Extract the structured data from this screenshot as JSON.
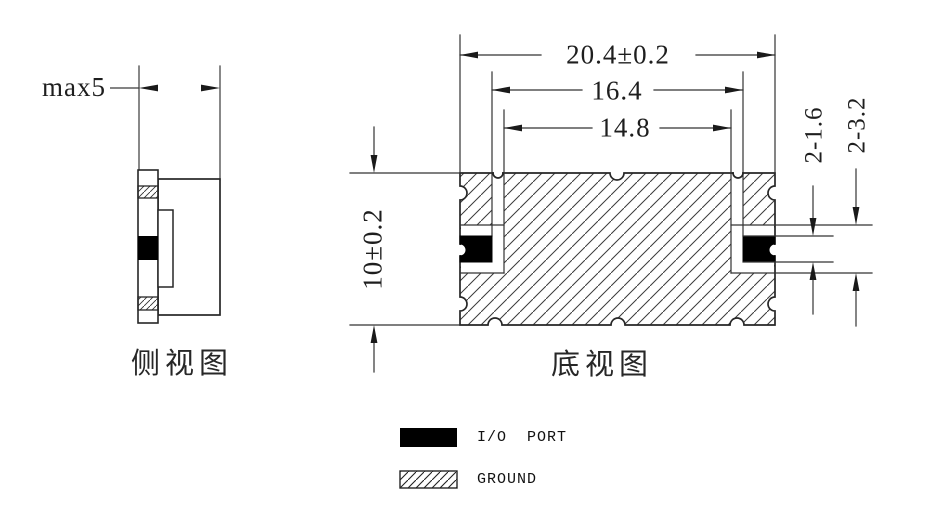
{
  "drawing": {
    "side_view": {
      "label": "侧视图",
      "dims": {
        "depth": "max5"
      }
    },
    "bottom_view": {
      "label": "底视图",
      "dims": {
        "overall_width": "20.4±0.2",
        "io_pad_inner_span": "16.4",
        "clearance_inner_span": "14.8",
        "overall_height": "10±0.2",
        "io_pad_height": "2-1.6",
        "clearance_height": "2-3.2"
      }
    },
    "legend": {
      "items": [
        {
          "id": "io-port",
          "label": "I/O  PORT",
          "swatch": "solid-black"
        },
        {
          "id": "ground",
          "label": "GROUND",
          "swatch": "hatched"
        }
      ]
    },
    "colors": {
      "line": "#262626",
      "io_port_fill": "#000000",
      "background": "#ffffff"
    }
  }
}
